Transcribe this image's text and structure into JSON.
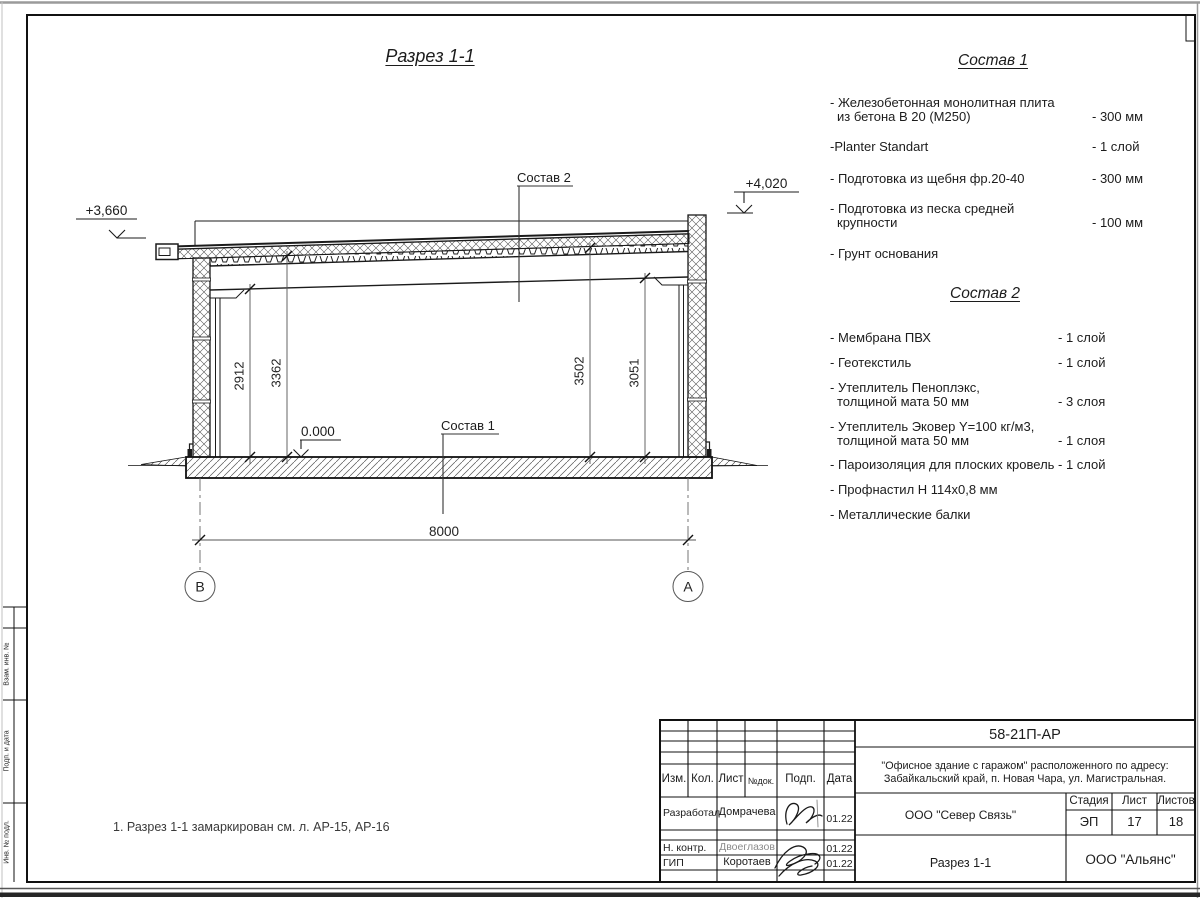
{
  "page": {
    "note": "1. Разрез 1-1 замаркирован см. л. АР-15, АР-16"
  },
  "section": {
    "title": "Разрез 1-1",
    "callout_top": "Состав 2",
    "callout_floor": "Состав 1",
    "elevation_left": "+3,660",
    "elevation_right": "+4,020",
    "elevation_zero": "0.000",
    "dims": {
      "beam_left": "2912",
      "deck_left": "3362",
      "deck_right": "3502",
      "beam_right": "3051",
      "span": "8000"
    },
    "axes": {
      "left": "В",
      "right": "А"
    }
  },
  "sostav1": {
    "title": "Состав 1",
    "items": [
      {
        "line1": "- Железобетонная  монолитная плита",
        "line2": "из бетона В 20 (М250)",
        "value": "- 300 мм"
      },
      {
        "line1": "-Planter Standart",
        "line2": "",
        "value": "- 1 слой"
      },
      {
        "line1": "- Подготовка из щебня фр.20-40",
        "line2": "",
        "value": "- 300 мм"
      },
      {
        "line1": "- Подготовка из песка средней",
        "line2": "крупности",
        "value": "- 100 мм"
      },
      {
        "line1": "- Грунт основания",
        "line2": "",
        "value": ""
      }
    ]
  },
  "sostav2": {
    "title": "Состав 2",
    "items": [
      {
        "line1": "- Мембрана ПВХ",
        "line2": "",
        "value": "- 1 слой"
      },
      {
        "line1": "- Геотекстиль",
        "line2": "",
        "value": "- 1 слой"
      },
      {
        "line1": "- Утеплитель Пеноплэкс,",
        "line2": "толщиной мата 50 мм",
        "value": "- 3  слоя"
      },
      {
        "line1": "- Утеплитель Эковер Y=100 кг/м3,",
        "line2": "толщиной мата 50 мм",
        "value": "- 1 слоя"
      },
      {
        "line1": "- Пароизоляция для плоских кровель",
        "line2": "",
        "value": "- 1 слой"
      },
      {
        "line1": "- Профнастил Н 114х0,8 мм",
        "line2": "",
        "value": ""
      },
      {
        "line1": "- Металлические балки",
        "line2": "",
        "value": ""
      }
    ]
  },
  "stamp": {
    "code": "58-21П-АР",
    "object_line1": "\"Офисное здание с гаражом\" расположенного по адресу:",
    "object_line2": "Забайкальский край, п. Новая Чара, ул. Магистральная.",
    "contractor": "ООО \"Север Связь\"",
    "drawing_name": "Разрез 1-1",
    "company": "ООО \"Альянс\"",
    "cols": {
      "izm": "Изм.",
      "kol": "Кол.",
      "list": "Лист",
      "ndok": "№док.",
      "podp": "Подп.",
      "data": "Дата"
    },
    "stage": {
      "label": "Стадия",
      "value": "ЭП"
    },
    "sheet": {
      "label": "Лист",
      "value": "17"
    },
    "sheets": {
      "label": "Листов",
      "value": "18"
    },
    "roles": [
      {
        "role": "Разработал",
        "name": "Домрачева",
        "date": "01.22"
      },
      {
        "role": "Н. контр.",
        "name": "Двоеглазов",
        "date": "01.22"
      },
      {
        "role": "ГИП",
        "name": "Коротаев",
        "date": "01.22"
      }
    ]
  },
  "side_strip": {
    "top": "Взам. инв. №",
    "middle": "Подп. и дата",
    "bottom": "Инв. № подл."
  }
}
